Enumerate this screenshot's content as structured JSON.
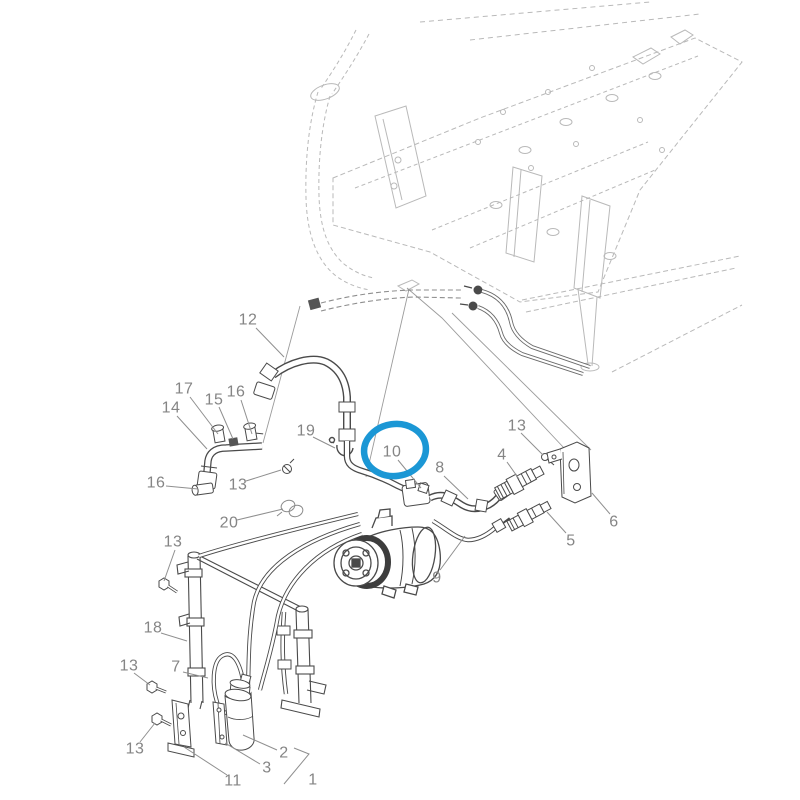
{
  "page": {
    "background": "#ffffff"
  },
  "diagram": {
    "type": "exploded-parts-diagram",
    "subject": "Air conditioning compressor, hoses and receiver drier assembly mounted under tractor chassis frame",
    "colors": {
      "part_line": "#4a4a4a",
      "frame_line": "#b9b9b9",
      "label": "#858585",
      "leader": "#8f8f8f",
      "highlight": "#1b97d5"
    },
    "label_font_size": 16,
    "highlight": {
      "shape": "ellipse",
      "cx": 395,
      "cy": 450,
      "rx": 31,
      "ry": 26,
      "rotation": -8,
      "stroke_width": 6.5,
      "highlighted_part": "10"
    },
    "callouts": [
      {
        "id": "part-label-12",
        "label": "12",
        "x": 248,
        "y": 320,
        "leader": [
          [
            256,
            328
          ],
          [
            284,
            357
          ]
        ]
      },
      {
        "id": "part-label-17",
        "label": "17",
        "x": 184,
        "y": 389,
        "leader": [
          [
            190,
            397
          ],
          [
            218,
            434
          ]
        ]
      },
      {
        "id": "part-label-15",
        "label": "15",
        "x": 214,
        "y": 400,
        "leader": [
          [
            219,
            407
          ],
          [
            233,
            439
          ]
        ]
      },
      {
        "id": "part-label-16a",
        "label": "16",
        "x": 236,
        "y": 392,
        "leader": [
          [
            241,
            400
          ],
          [
            252,
            434
          ]
        ]
      },
      {
        "id": "part-label-14",
        "label": "14",
        "x": 171,
        "y": 408,
        "leader": [
          [
            177,
            416
          ],
          [
            207,
            449
          ]
        ]
      },
      {
        "id": "part-label-19",
        "label": "19",
        "x": 306,
        "y": 431,
        "leader": [
          [
            313,
            437
          ],
          [
            335,
            448
          ]
        ]
      },
      {
        "id": "part-label-10",
        "label": "10",
        "x": 392,
        "y": 452,
        "leader": [
          [
            398,
            460
          ],
          [
            421,
            488
          ]
        ]
      },
      {
        "id": "part-label-13a",
        "label": "13",
        "x": 517,
        "y": 426,
        "leader": [
          [
            521,
            433
          ],
          [
            543,
            455
          ]
        ]
      },
      {
        "id": "part-label-4",
        "label": "4",
        "x": 502,
        "y": 455,
        "leader": [
          [
            507,
            462
          ],
          [
            519,
            479
          ]
        ]
      },
      {
        "id": "part-label-8",
        "label": "8",
        "x": 440,
        "y": 468,
        "leader": [
          [
            444,
            476
          ],
          [
            468,
            499
          ]
        ]
      },
      {
        "id": "part-label-6",
        "label": "6",
        "x": 614,
        "y": 522,
        "leader": [
          [
            610,
            514
          ],
          [
            592,
            493
          ]
        ]
      },
      {
        "id": "part-label-5",
        "label": "5",
        "x": 571,
        "y": 541,
        "leader": [
          [
            566,
            533
          ],
          [
            547,
            512
          ]
        ]
      },
      {
        "id": "part-label-16b",
        "label": "16",
        "x": 156,
        "y": 483,
        "leader": [
          [
            166,
            486
          ],
          [
            198,
            489
          ]
        ]
      },
      {
        "id": "part-label-13b",
        "label": "13",
        "x": 238,
        "y": 485,
        "leader": [
          [
            246,
            481
          ],
          [
            281,
            470
          ]
        ]
      },
      {
        "id": "part-label-20",
        "label": "20",
        "x": 229,
        "y": 523,
        "leader": [
          [
            237,
            520
          ],
          [
            283,
            509
          ]
        ]
      },
      {
        "id": "part-label-9",
        "label": "9",
        "x": 437,
        "y": 578,
        "leader": [
          [
            440,
            570
          ],
          [
            465,
            536
          ]
        ]
      },
      {
        "id": "part-label-13c",
        "label": "13",
        "x": 173,
        "y": 542,
        "leader": [
          [
            175,
            550
          ],
          [
            164,
            581
          ]
        ]
      },
      {
        "id": "part-label-18",
        "label": "18",
        "x": 153,
        "y": 628,
        "leader": [
          [
            161,
            633
          ],
          [
            187,
            641
          ]
        ]
      },
      {
        "id": "part-label-13d",
        "label": "13",
        "x": 129,
        "y": 666,
        "leader": [
          [
            134,
            673
          ],
          [
            150,
            685
          ]
        ]
      },
      {
        "id": "part-label-7",
        "label": "7",
        "x": 176,
        "y": 667,
        "leader": [
          [
            183,
            672
          ],
          [
            208,
            678
          ]
        ]
      },
      {
        "id": "part-label-13e",
        "label": "13",
        "x": 135,
        "y": 749,
        "leader": [
          [
            140,
            742
          ],
          [
            155,
            723
          ]
        ]
      },
      {
        "id": "part-label-11",
        "label": "11",
        "x": 233,
        "y": 781,
        "leader": [
          [
            227,
            775
          ],
          [
            184,
            747
          ]
        ]
      },
      {
        "id": "part-label-2",
        "label": "2",
        "x": 284,
        "y": 753,
        "leader": [
          [
            277,
            750
          ],
          [
            243,
            735
          ]
        ]
      },
      {
        "id": "part-label-3",
        "label": "3",
        "x": 267,
        "y": 768,
        "leader": [
          [
            260,
            764
          ],
          [
            225,
            743
          ]
        ]
      },
      {
        "id": "part-label-1",
        "label": "1",
        "x": 313,
        "y": 780,
        "leader": [
          [
            294,
            748
          ],
          [
            309,
            754
          ],
          [
            284,
            784
          ]
        ]
      }
    ]
  }
}
